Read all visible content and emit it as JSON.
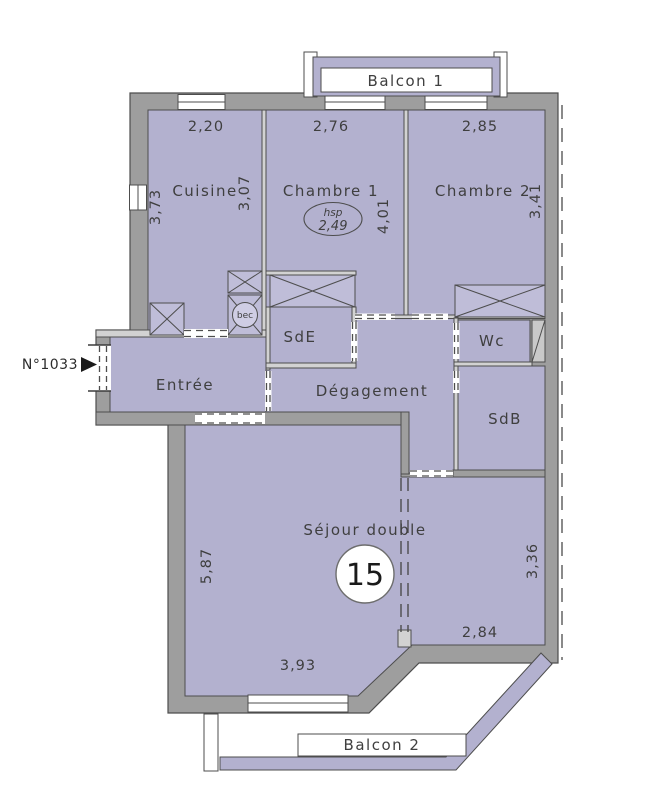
{
  "plan": {
    "lot_door_label": "N°1033",
    "lot_number": "15",
    "labels": {
      "balcon1": "Balcon 1",
      "balcon2": "Balcon 2",
      "cuisine": "Cuisine",
      "chambre1": "Chambre 1",
      "chambre2": "Chambre 2",
      "entree": "Entrée",
      "sde": "SdE",
      "degagement": "Dégagement",
      "wc": "Wc",
      "sdb": "SdB",
      "sejour": "Séjour double",
      "bec": "bec",
      "hsp_label": "hsp",
      "hsp_value": "2,49"
    },
    "dimensions": {
      "cuisine_width": "2,20",
      "cuisine_height_left": "3,73",
      "cuisine_height_right": "3,07",
      "chambre1_width": "2,76",
      "chambre1_height": "4,01",
      "chambre2_width": "2,85",
      "chambre2_height": "3,41",
      "sejour_height_left": "5,87",
      "sejour_width_bottom": "3,93",
      "sejour_right_height": "3,36",
      "sejour_right_width": "2,84"
    },
    "colors": {
      "room_fill": "#b3b1cf",
      "closet_fill": "#bfbdd8",
      "wall_fill": "#9e9e9e",
      "thin_wall_fill": "#d2d2d2",
      "line": "#4d4d4d",
      "text": "#3f3f3f",
      "background": "#ffffff"
    }
  }
}
